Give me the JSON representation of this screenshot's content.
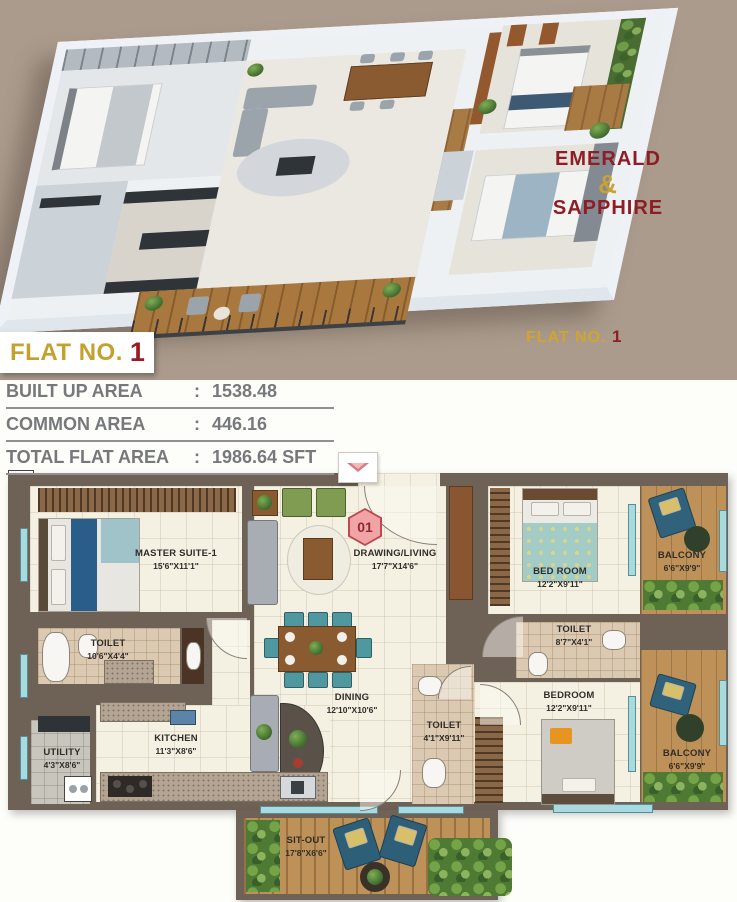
{
  "colors": {
    "backdrop_tan": "#AB9B8C",
    "gold": "#C6A02E",
    "brand_red": "#8F1D26",
    "wall": "#6E6156",
    "entry_pink": "#F2A3A6"
  },
  "brand": {
    "line1": "EMERALD",
    "amp": "&",
    "line2": "SAPPHIRE",
    "corner_label": "FLAT NO.",
    "corner_number": "1"
  },
  "title": {
    "label": "FLAT NO.",
    "number": "1"
  },
  "area_table": {
    "rows": [
      {
        "label": "BUILT UP AREA",
        "sep": ":",
        "value": "1538.48"
      },
      {
        "label": "COMMON AREA",
        "sep": ":",
        "value": "446.16"
      },
      {
        "label": "TOTAL FLAT AREA",
        "sep": ":",
        "value": "1986.64 SFT"
      }
    ]
  },
  "floorplan": {
    "entrance_no": "01",
    "dw": "DW",
    "wm": "WM",
    "rooms": [
      {
        "name": "MASTER SUITE-1",
        "dim": "15'6\"X11'1\""
      },
      {
        "name": "DRAWING/LIVING",
        "dim": "17'7\"X14'6\""
      },
      {
        "name": "BED ROOM",
        "dim": "12'2\"X9'11\""
      },
      {
        "name": "BALCONY",
        "dim": "6'6\"X9'9\""
      },
      {
        "name": "TOILET",
        "dim": "10'6\"X4'4\""
      },
      {
        "name": "TOILET",
        "dim": "8'7\"X4'1\""
      },
      {
        "name": "DINING",
        "dim": "12'10\"X10'6\""
      },
      {
        "name": "TOILET",
        "dim": "4'1\"X9'11\""
      },
      {
        "name": "BEDROOM",
        "dim": "12'2\"X9'11\""
      },
      {
        "name": "BALCONY",
        "dim": "6'6\"X9'9\""
      },
      {
        "name": "UTILITY",
        "dim": "4'3\"X8'6\""
      },
      {
        "name": "KITCHEN",
        "dim": "11'3\"X8'6\""
      },
      {
        "name": "SIT-OUT",
        "dim": "17'8\"X6'6\""
      }
    ]
  }
}
